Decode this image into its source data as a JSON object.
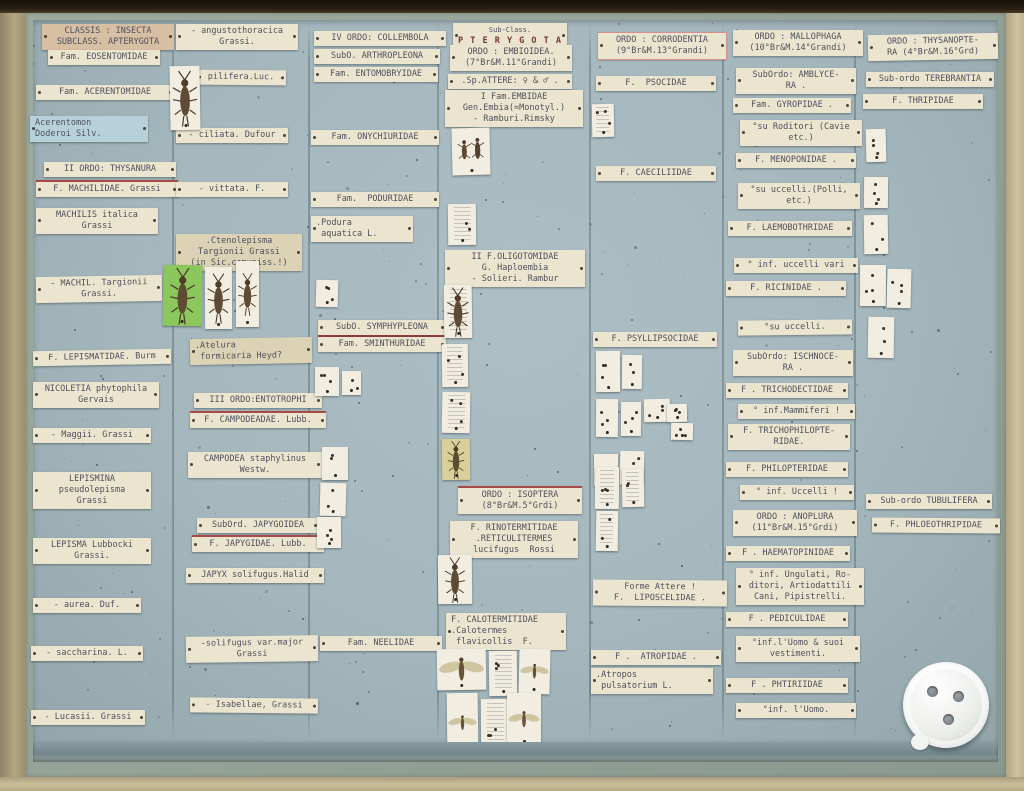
{
  "scene": {
    "description": "Museum entomology display case: blue-grey pinboard with typewritten taxonomic labels and pinned insect specimens",
    "palette": {
      "board": "#a4b7bd",
      "frame_wood": "#b3a682",
      "frame_lip": "#93a298",
      "label_paper": "#ebe5d0",
      "label_tan": "#d6bfa3",
      "label_blue": "#b7d1da",
      "label_aged": "#dcd2b6",
      "accent_red": "#a84a48",
      "disc_white": "#eceeea"
    }
  },
  "labels": [
    {
      "t": "CLASSIS : INSECTA\nSUBCLASS. APTERYGOTA",
      "x": 42,
      "y": 24,
      "w": 132,
      "bg": "tan"
    },
    {
      "t": "Fam. EOSENTOMIDAE",
      "x": 48,
      "y": 50,
      "w": 112
    },
    {
      "t": "Fam. ACERENTOMIDAE",
      "x": 36,
      "y": 85,
      "w": 138
    },
    {
      "t": "Acerentomon\nDoderoi Silv.",
      "x": 30,
      "y": 116,
      "w": 118,
      "bg": "blue",
      "al": "left"
    },
    {
      "t": "II ORDO: THYSANURA",
      "x": 44,
      "y": 162,
      "w": 132
    },
    {
      "t": "F. MACHILIDAE. Grassi",
      "x": 36,
      "y": 180,
      "w": 142,
      "ac": "top"
    },
    {
      "t": "MACHILIS italica\nGrassi",
      "x": 36,
      "y": 208,
      "w": 122
    },
    {
      "t": "- MACHIL. Targionii\nGrassi.",
      "x": 36,
      "y": 276,
      "w": 126,
      "rot": -1
    },
    {
      "t": "F. LEPISMATIDAE. Burm",
      "x": 33,
      "y": 350,
      "w": 138,
      "rot": -1
    },
    {
      "t": "NICOLETIA phytophila\nGervais",
      "x": 33,
      "y": 382,
      "w": 126
    },
    {
      "t": "- Maggii. Grassi",
      "x": 33,
      "y": 428,
      "w": 118
    },
    {
      "t": "LEPISMINA\npseudolepisma\nGrassi",
      "x": 33,
      "y": 472,
      "w": 118
    },
    {
      "t": "LEPISMA Lubbocki\nGrassi.",
      "x": 33,
      "y": 538,
      "w": 118
    },
    {
      "t": "- aurea. Duf.",
      "x": 33,
      "y": 598,
      "w": 108
    },
    {
      "t": "- saccharina. L.",
      "x": 31,
      "y": 646,
      "w": 112
    },
    {
      "t": "- Lucasii. Grassi",
      "x": 31,
      "y": 710,
      "w": 114
    },
    {
      "t": "- angustothoracica\nGrassi.",
      "x": 176,
      "y": 24,
      "w": 122
    },
    {
      "t": "pilifera.Luc.",
      "x": 196,
      "y": 70,
      "w": 90,
      "rot": 0.5
    },
    {
      "t": "- ciliata. Dufour",
      "x": 176,
      "y": 128,
      "w": 112
    },
    {
      "t": "- vittata. F.",
      "x": 176,
      "y": 182,
      "w": 112
    },
    {
      "t": ".Ctenolepisma\nTargionii Grassi\n(in Sic.comuniss.!)",
      "x": 176,
      "y": 234,
      "w": 126,
      "bg": "aged"
    },
    {
      "t": ".Atelura\n formicaria Heyd?",
      "x": 190,
      "y": 338,
      "w": 122,
      "bg": "aged",
      "rot": -1,
      "al": "left"
    },
    {
      "t": "III ORDO:ENTOTROPHI",
      "x": 194,
      "y": 393,
      "w": 128
    },
    {
      "t": "F. CAMPODEADAE. Lubb.",
      "x": 190,
      "y": 411,
      "w": 136,
      "ac": "top"
    },
    {
      "t": "CAMPODEA staphylinus\nWestw.",
      "x": 188,
      "y": 452,
      "w": 134
    },
    {
      "t": "SubOrd. JAPYGOIDEA",
      "x": 197,
      "y": 518,
      "w": 122
    },
    {
      "t": "F. JAPYGIDAE. Lubb.",
      "x": 192,
      "y": 535,
      "w": 132,
      "ac": "top"
    },
    {
      "t": "JAPYX solifugus.Halid",
      "x": 186,
      "y": 568,
      "w": 138
    },
    {
      "t": "-solifugus var.major\nGrassi",
      "x": 186,
      "y": 636,
      "w": 132,
      "rot": -0.8
    },
    {
      "t": "- Isabellae, Grassi",
      "x": 190,
      "y": 698,
      "w": 128,
      "rot": 0.6
    },
    {
      "t": "IV ORDO: COLLEMBOLA",
      "x": 314,
      "y": 31,
      "w": 132
    },
    {
      "t": "SubO. ARTHROPLEONA",
      "x": 314,
      "y": 49,
      "w": 126
    },
    {
      "t": "Fam. ENTOMOBRYIDAE",
      "x": 314,
      "y": 67,
      "w": 124
    },
    {
      "t": "Fam. ONYCHIURIDAE",
      "x": 311,
      "y": 130,
      "w": 128
    },
    {
      "t": "Fam.  PODURIDAE",
      "x": 311,
      "y": 192,
      "w": 128
    },
    {
      "t": ".Podura\n aquatica L.",
      "x": 311,
      "y": 216,
      "w": 102,
      "al": "left"
    },
    {
      "t": "SubO. SYMPHYPLEONA",
      "x": 318,
      "y": 320,
      "w": 128,
      "ac": "bottom"
    },
    {
      "t": "Fam. SMINTHURIDAE",
      "x": 318,
      "y": 337,
      "w": 128
    },
    {
      "t": "Fam. NEELIDAE",
      "x": 320,
      "y": 636,
      "w": 122
    },
    {
      "t": "Sub-Class.\nP T E R Y G O T A",
      "x": 453,
      "y": 23,
      "w": 114,
      "cls": "pt"
    },
    {
      "t": "ORDO : EMBIOIDEA.\n(7°Br&M.11°Grandi)",
      "x": 450,
      "y": 45,
      "w": 122
    },
    {
      "t": ".Sp.ATTERE: ♀ & ♂ .",
      "x": 448,
      "y": 74,
      "w": 124
    },
    {
      "t": "I Fam.EMBIDAE\nGen.Embia(=Monotyl.)\n- Ramburi.Rimsky",
      "x": 445,
      "y": 90,
      "w": 138
    },
    {
      "t": "II F.OLIGOTOMIDAE\nG. Haploembia\n- Solieri. Rambur",
      "x": 445,
      "y": 250,
      "w": 140
    },
    {
      "t": "ORDO : ISOPTERA\n(8°Br&M.5°Grdi)",
      "x": 458,
      "y": 486,
      "w": 124,
      "ac": "top"
    },
    {
      "t": "F. RINOTERMITIDAE\n.RETICULITERMES\nlucifugus  Rossi",
      "x": 450,
      "y": 521,
      "w": 128
    },
    {
      "t": "F. CALOTERMITIDAE\n.Calotermes\n flavicollis  F.",
      "x": 446,
      "y": 613,
      "w": 120,
      "al": "left"
    },
    {
      "t": "ORDO : CORRODENTIA\n(9°Br&M.13°Grandi)",
      "x": 598,
      "y": 33,
      "w": 128,
      "ac": "box"
    },
    {
      "t": "F.  PSOCIDAE",
      "x": 596,
      "y": 76,
      "w": 120
    },
    {
      "t": "F. CAECILIIDAE",
      "x": 596,
      "y": 166,
      "w": 120
    },
    {
      "t": "F. PSYLLIPSOCIDAE",
      "x": 593,
      "y": 332,
      "w": 124
    },
    {
      "t": "Forme Attere !\nF.  LIPOSCELIDAE .",
      "x": 593,
      "y": 580,
      "w": 134,
      "rot": 0.4
    },
    {
      "t": "F .  ATROPIDAE .",
      "x": 591,
      "y": 650,
      "w": 130
    },
    {
      "t": ".Atropos\n pulsatorium L.",
      "x": 591,
      "y": 668,
      "w": 122,
      "al": "left"
    },
    {
      "t": "ORDO : MALLOPHAGA\n(10°Br&M.14°Grandi)",
      "x": 733,
      "y": 30,
      "w": 130
    },
    {
      "t": "SubOrdo: AMBLYCE-\nRA .",
      "x": 736,
      "y": 68,
      "w": 120
    },
    {
      "t": "Fam. GYROPIDAE .",
      "x": 733,
      "y": 98,
      "w": 118
    },
    {
      "t": "°su Roditori (Cavie\netc.)",
      "x": 740,
      "y": 120,
      "w": 122
    },
    {
      "t": "F. MENOPONIDAE .",
      "x": 736,
      "y": 153,
      "w": 120
    },
    {
      "t": "°su uccelli.(Polli,\netc.)",
      "x": 738,
      "y": 183,
      "w": 122
    },
    {
      "t": "F. LAEMOBOTHRIDAE",
      "x": 728,
      "y": 221,
      "w": 124
    },
    {
      "t": "° inf. uccelli vari",
      "x": 734,
      "y": 258,
      "w": 124
    },
    {
      "t": "F. RICINIDAE .",
      "x": 726,
      "y": 281,
      "w": 120
    },
    {
      "t": "°su uccelli.",
      "x": 738,
      "y": 320,
      "w": 114,
      "rot": -0.6
    },
    {
      "t": "SubOrdo: ISCHNOCE-\nRA .",
      "x": 733,
      "y": 350,
      "w": 120
    },
    {
      "t": "F . TRICHODECTIDAE",
      "x": 726,
      "y": 383,
      "w": 122
    },
    {
      "t": "° inf.Mammiferi !",
      "x": 738,
      "y": 404,
      "w": 117
    },
    {
      "t": "F. TRICHOPHILOPTE-\nRIDAE.",
      "x": 728,
      "y": 424,
      "w": 122
    },
    {
      "t": "F. PHILOPTERIDAE",
      "x": 726,
      "y": 462,
      "w": 122
    },
    {
      "t": "° inf. Uccelli !",
      "x": 740,
      "y": 485,
      "w": 114
    },
    {
      "t": "ORDO : ANOPLURA\n(11°Br&M.15°Grdi)",
      "x": 733,
      "y": 510,
      "w": 124
    },
    {
      "t": "F . HAEMATOPINIDAE",
      "x": 726,
      "y": 546,
      "w": 124
    },
    {
      "t": "° inf. Ungulati, Ro-\nditori, Artiodattili\nCani, Pipistrelli.",
      "x": 736,
      "y": 568,
      "w": 128
    },
    {
      "t": "F . PEDICULIDAE",
      "x": 726,
      "y": 612,
      "w": 122
    },
    {
      "t": "°inf.l'Uomo & suoi\nvestimenti.",
      "x": 736,
      "y": 636,
      "w": 124
    },
    {
      "t": "F . PHTIRIIDAE",
      "x": 726,
      "y": 678,
      "w": 122
    },
    {
      "t": "°inf. l'Uomo.",
      "x": 736,
      "y": 703,
      "w": 120
    },
    {
      "t": "ORDO : THYSANOPTE-\nRA (4°Br&M.16°Grd)",
      "x": 868,
      "y": 34,
      "w": 130,
      "rot": -1
    },
    {
      "t": "Sub-ordo TEREBRANTIA",
      "x": 866,
      "y": 72,
      "w": 128
    },
    {
      "t": "F. THRIPIDAE",
      "x": 863,
      "y": 94,
      "w": 120
    },
    {
      "t": "Sub-ordo TUBULIFERA",
      "x": 866,
      "y": 494,
      "w": 126
    },
    {
      "t": "F. PHLOEOTHRIPIDAE",
      "x": 872,
      "y": 518,
      "w": 128,
      "rot": 0.5
    }
  ],
  "specimens": [
    {
      "x": 170,
      "y": 66,
      "w": 30,
      "h": 64,
      "k": "bug"
    },
    {
      "x": 163,
      "y": 265,
      "w": 39,
      "h": 61,
      "k": "green"
    },
    {
      "x": 205,
      "y": 267,
      "w": 27,
      "h": 62,
      "k": "bug"
    },
    {
      "x": 236,
      "y": 261,
      "w": 23,
      "h": 66,
      "k": "bug"
    },
    {
      "x": 316,
      "y": 280,
      "w": 22,
      "h": 27,
      "k": "dots"
    },
    {
      "x": 315,
      "y": 367,
      "w": 24,
      "h": 29,
      "k": "dots"
    },
    {
      "x": 342,
      "y": 371,
      "w": 19,
      "h": 24,
      "k": "dots"
    },
    {
      "x": 322,
      "y": 447,
      "w": 26,
      "h": 33,
      "k": "dots"
    },
    {
      "x": 320,
      "y": 483,
      "w": 26,
      "h": 33,
      "k": "dots"
    },
    {
      "x": 317,
      "y": 517,
      "w": 24,
      "h": 31,
      "k": "dots"
    },
    {
      "x": 452,
      "y": 128,
      "w": 38,
      "h": 47,
      "k": "bug2"
    },
    {
      "x": 448,
      "y": 204,
      "w": 28,
      "h": 41,
      "k": "tall"
    },
    {
      "x": 444,
      "y": 285,
      "w": 28,
      "h": 53,
      "k": "bugtall"
    },
    {
      "x": 442,
      "y": 344,
      "w": 26,
      "h": 43,
      "k": "tall"
    },
    {
      "x": 442,
      "y": 392,
      "w": 28,
      "h": 41,
      "k": "tall"
    },
    {
      "x": 442,
      "y": 439,
      "w": 28,
      "h": 41,
      "k": "yellow"
    },
    {
      "x": 438,
      "y": 555,
      "w": 34,
      "h": 49,
      "k": "bug"
    },
    {
      "x": 437,
      "y": 649,
      "w": 49,
      "h": 41,
      "k": "winged"
    },
    {
      "x": 489,
      "y": 651,
      "w": 28,
      "h": 45,
      "k": "tall"
    },
    {
      "x": 519,
      "y": 649,
      "w": 31,
      "h": 45,
      "k": "winged"
    },
    {
      "x": 447,
      "y": 693,
      "w": 31,
      "h": 60,
      "k": "winged"
    },
    {
      "x": 481,
      "y": 699,
      "w": 28,
      "h": 55,
      "k": "tall"
    },
    {
      "x": 507,
      "y": 693,
      "w": 34,
      "h": 53,
      "k": "winged"
    },
    {
      "x": 592,
      "y": 104,
      "w": 22,
      "h": 33,
      "k": "tall"
    },
    {
      "x": 596,
      "y": 351,
      "w": 24,
      "h": 41,
      "k": "dots"
    },
    {
      "x": 622,
      "y": 355,
      "w": 20,
      "h": 34,
      "k": "dots"
    },
    {
      "x": 596,
      "y": 399,
      "w": 22,
      "h": 38,
      "k": "dots"
    },
    {
      "x": 621,
      "y": 402,
      "w": 20,
      "h": 34,
      "k": "dots"
    },
    {
      "x": 644,
      "y": 399,
      "w": 26,
      "h": 23,
      "k": "dots"
    },
    {
      "x": 667,
      "y": 404,
      "w": 20,
      "h": 18,
      "k": "dots"
    },
    {
      "x": 671,
      "y": 423,
      "w": 22,
      "h": 17,
      "k": "dots"
    },
    {
      "x": 594,
      "y": 454,
      "w": 24,
      "h": 32,
      "k": "dots"
    },
    {
      "x": 620,
      "y": 451,
      "w": 24,
      "h": 34,
      "k": "dots"
    },
    {
      "x": 595,
      "y": 467,
      "w": 24,
      "h": 42,
      "k": "tall"
    },
    {
      "x": 622,
      "y": 469,
      "w": 22,
      "h": 38,
      "k": "tall"
    },
    {
      "x": 596,
      "y": 511,
      "w": 22,
      "h": 40,
      "k": "tall"
    },
    {
      "x": 866,
      "y": 129,
      "w": 20,
      "h": 33,
      "k": "dots"
    },
    {
      "x": 864,
      "y": 177,
      "w": 24,
      "h": 31,
      "k": "dots"
    },
    {
      "x": 864,
      "y": 215,
      "w": 24,
      "h": 39,
      "k": "dots"
    },
    {
      "x": 860,
      "y": 265,
      "w": 26,
      "h": 41,
      "k": "dots"
    },
    {
      "x": 887,
      "y": 269,
      "w": 24,
      "h": 39,
      "k": "dots"
    },
    {
      "x": 868,
      "y": 317,
      "w": 26,
      "h": 41,
      "k": "dots"
    }
  ],
  "dividers_x": [
    172,
    308,
    437,
    589,
    722,
    854
  ],
  "disc": {
    "holes": 3
  }
}
